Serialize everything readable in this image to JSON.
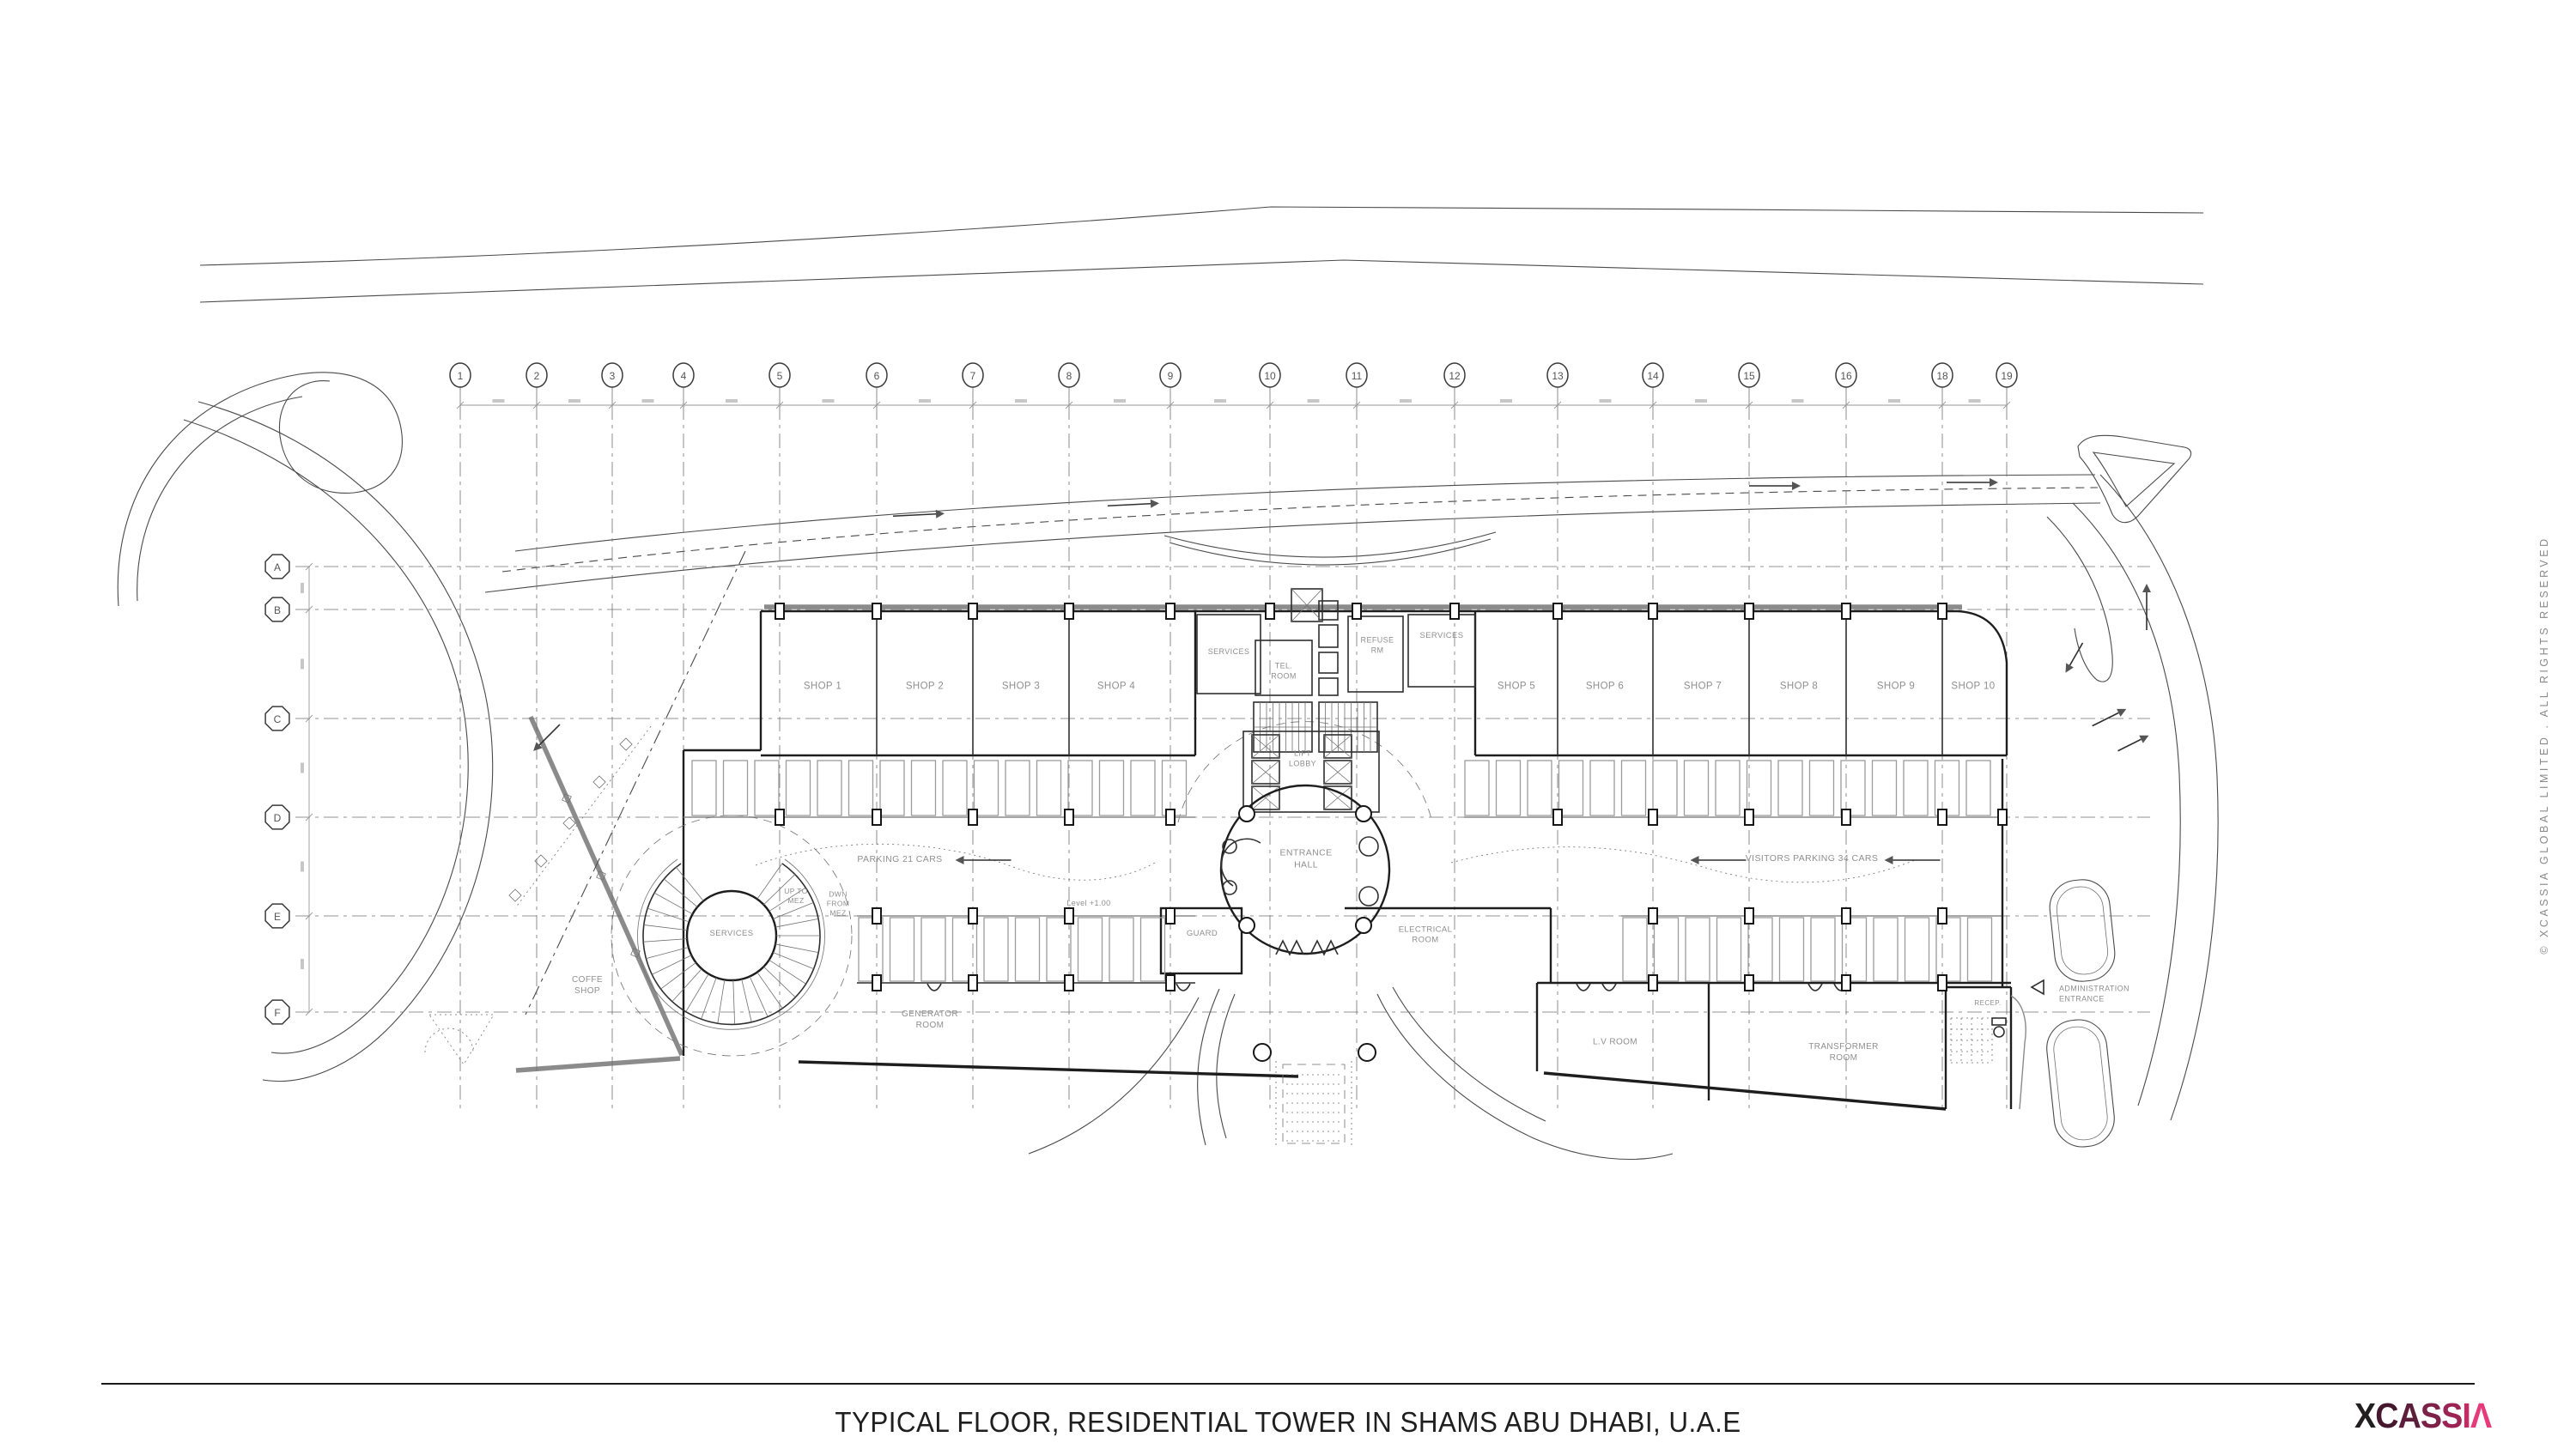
{
  "sheet": {
    "title": "TYPICAL FLOOR, RESIDENTIAL TOWER IN SHAMS ABU DHABI, U.A.E",
    "copyright": "© XCASSIA GLOBAL LIMITED . ALL RIGHTS RESERVED"
  },
  "brand": {
    "name": "XCASSIA",
    "accent": "#e63a7b",
    "logo_chars": [
      {
        "ch": "X",
        "color": "#231f20"
      },
      {
        "ch": "C",
        "color": "#45182e"
      },
      {
        "ch": "A",
        "color": "#5c1e3b"
      },
      {
        "ch": "S",
        "color": "#7d2149"
      },
      {
        "ch": "S",
        "color": "#9c2455"
      },
      {
        "ch": "I",
        "color": "#c22b64"
      },
      {
        "ch": "Λ",
        "color": "#e63a7b"
      }
    ]
  },
  "grid": {
    "columns": [
      "1",
      "2",
      "3",
      "4",
      "5",
      "6",
      "7",
      "8",
      "9",
      "10",
      "11",
      "12",
      "13",
      "14",
      "15",
      "16",
      "18",
      "19"
    ],
    "rows": [
      "A",
      "B",
      "C",
      "D",
      "E",
      "F"
    ]
  },
  "labels": {
    "shop1": "SHOP 1",
    "shop2": "SHOP 2",
    "shop3": "SHOP 3",
    "shop4": "SHOP 4",
    "shop5": "SHOP 5",
    "shop6": "SHOP 6",
    "shop7": "SHOP 7",
    "shop8": "SHOP 8",
    "shop9": "SHOP 9",
    "shop10": "SHOP 10",
    "services_left": "SERVICES",
    "tel_room": "TEL.\nROOM",
    "refuse_rm": "REFUSE\nRM",
    "services_right": "SERVICES",
    "lift_lobby": "LIFT\nLOBBY",
    "entrance_hall": "ENTRANCE\nHALL",
    "electrical_room": "ELECTRICAL\nROOM",
    "guard": "GUARD",
    "level": "Level +1.00",
    "parking_left": "PARKING 21 CARS",
    "parking_right": "VISITORS PARKING 34 CARS",
    "coffee_shop": "COFFE\nSHOP",
    "services_spiral": "SERVICES",
    "up_to_mez": "UP TO\nMEZ",
    "dwn_from_mez": "DWN\nFROM\nMEZ",
    "generator_room": "GENERATOR\nROOM",
    "lv_room": "L.V ROOM",
    "transformer_room": "TRANSFORMER\nROOM",
    "recep": "RECEP.",
    "admin_entrance": "ADMINISTRATION\nENTRANCE"
  }
}
